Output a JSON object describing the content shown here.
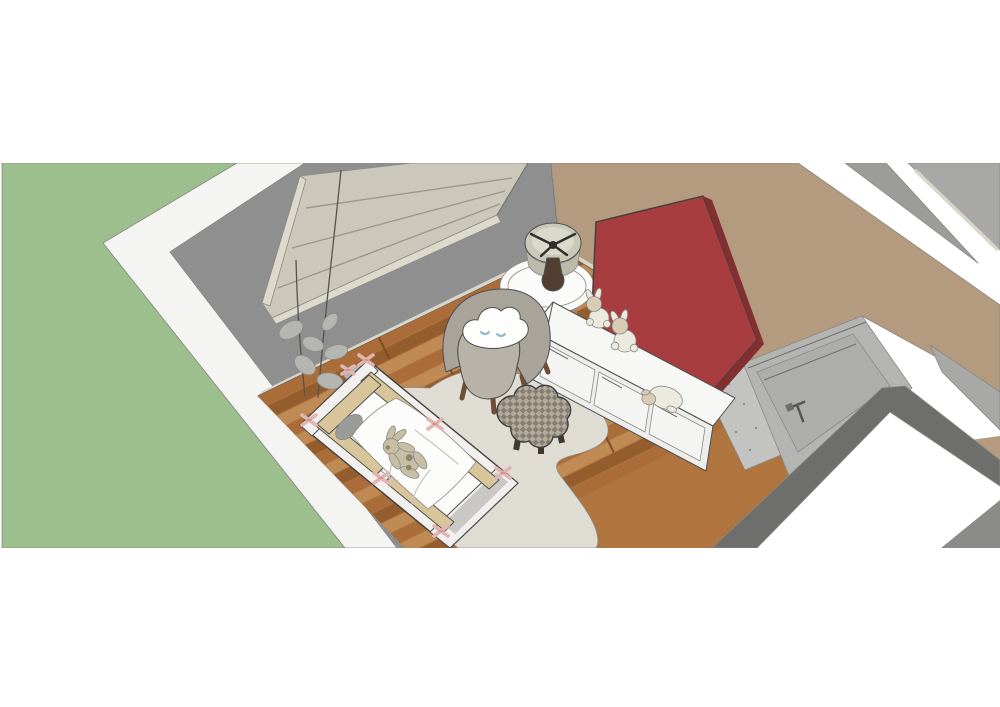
{
  "scene": {
    "title": "Nursery room 3D render (top-down cutaway view)",
    "style": "sketchup-like architectural rendering, no visible UI chrome",
    "objects": [
      {
        "id": "lawn",
        "label": "Green lawn outside the house"
      },
      {
        "id": "exterior-wall-top",
        "label": "White top edge of exterior walls (cutaway)"
      },
      {
        "id": "left-wall",
        "label": "Gray wall with window"
      },
      {
        "id": "roman-blinds",
        "label": "Beige roman blinds covering the window"
      },
      {
        "id": "tan-wall",
        "label": "Tan/beige accent wall of the nursery"
      },
      {
        "id": "red-house-panel",
        "label": "Dark red house-shaped wall panel behind dresser"
      },
      {
        "id": "wood-floor",
        "label": "Wood plank flooring"
      },
      {
        "id": "area-rug",
        "label": "Cream organic-shaped area rug"
      },
      {
        "id": "crib",
        "label": "White crib with tan bumper pads tied with pink bows"
      },
      {
        "id": "crib-bedding",
        "label": "White duvet and gray pillow inside crib"
      },
      {
        "id": "plush-bunny-crib",
        "label": "Plush bunny lying on the crib duvet"
      },
      {
        "id": "plant",
        "label": "Sketchy potted plant behind the crib"
      },
      {
        "id": "armchair",
        "label": "Gray tub armchair"
      },
      {
        "id": "cloud-pillow",
        "label": "White cloud pillow with sleeping face on armchair"
      },
      {
        "id": "side-table",
        "label": "Round white side table"
      },
      {
        "id": "table-lamp",
        "label": "Drum-shade table lamp seen from above"
      },
      {
        "id": "dresser",
        "label": "White low dresser / storage bench with three drawers"
      },
      {
        "id": "plush-bunny-1",
        "label": "Small plush bunny on dresser"
      },
      {
        "id": "plush-bunny-2",
        "label": "Small plush bunny on dresser"
      },
      {
        "id": "plush-lamb",
        "label": "Plush lamb on dresser"
      },
      {
        "id": "pouf",
        "label": "Flower-shaped checkered pouf ottoman"
      },
      {
        "id": "door",
        "label": "Gray room door with handle"
      },
      {
        "id": "adjacent-rooms",
        "label": "Gray floors/walls of adjacent rooms (top right)"
      }
    ]
  },
  "colors": {
    "page_bg": "#ffffff",
    "lawn": "#9dbe8d",
    "wall_top_white": "#f4f4f2",
    "wall_gray": "#8f8f8f",
    "blinds": "#cbc7ba",
    "window_frame": "#ddd9cc",
    "wall_tan": "#b49a7e",
    "adjacent_gray_a": "#9c9c9a",
    "adjacent_gray_b": "#a8a8a6",
    "floor_base": "#b0743f",
    "plank_light": "#c08a54",
    "plank_mid": "#aa6c38",
    "plank_dark": "#935d2e",
    "plank_seam": "#7c4e26",
    "rug": "#dfdcd3",
    "skirting": "#d9d6cb",
    "speckle_band": "#c3c3c1",
    "speckle_dot": "#8d8d8b",
    "door_band": "#b4b4b2",
    "door_slab": "#adadab",
    "dark_band": "#6e6e6c",
    "corner_gray": "#8b8b89",
    "crib_white": "#f1f0ee",
    "crib_panel": "#c9c8c4",
    "bumper": "#d8c59a",
    "bedding": "#fcfcfb",
    "pillow_gray": "#9b9b97",
    "bunny_fur": "#c7bfa5",
    "bunny_patch": "#8e8668",
    "chair_shell": "#a9a49a",
    "chair_seat": "#b8b3a9",
    "chair_inner": "#8f8a80",
    "cloud_white": "#fdfdfc",
    "table_top": "#fbfbf9",
    "lamp_shade": "#c9c9b9",
    "lamp_inner": "#dadaca",
    "lamp_side": "#bbbba9",
    "lamp_base": "#523f2f",
    "dresser_top": "#f7f7f5",
    "dresser_front": "#ededeb",
    "drawer_face": "#f4f4f2",
    "red_panel": "#a73d3f",
    "red_panel_edge": "#822f32",
    "plush_white": "#ece9df",
    "plush_beige": "#d8ccb4",
    "pouf_base": "#867e70",
    "pouf_grid": "#b3ab9c",
    "pouf_leg": "#3e382f",
    "leaf_gray": "#b5b5b1"
  }
}
